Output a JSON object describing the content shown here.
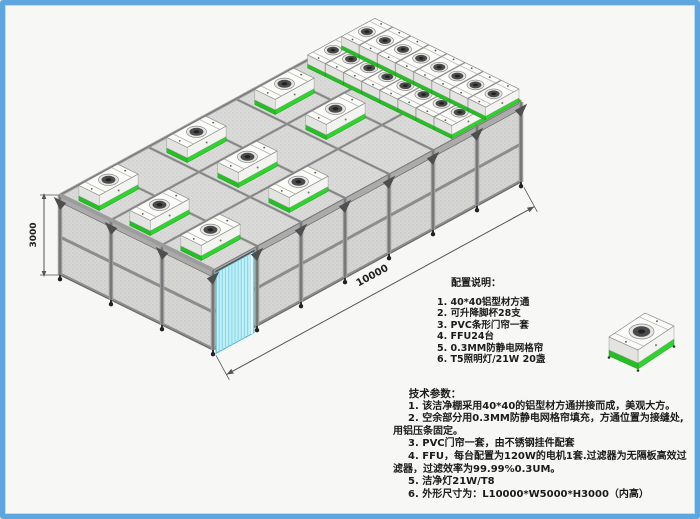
{
  "dimensions": {
    "height_mm": "3000",
    "length_mm": "10000"
  },
  "config_notes": {
    "heading": "配置说明：",
    "items": [
      "1. 40*40铝型材方通",
      "2. 可升降脚杯28支",
      "3. PVC条形门帘一套",
      "4. FFU24台",
      "5. 0.3MM防静电网格帘",
      "6. T5照明灯/21W 20盏"
    ]
  },
  "tech_params": {
    "heading": "技术参数：",
    "items": [
      "1. 该洁净棚采用40*40的铝型材方通拼接而成，美观大方。",
      "2. 空余部分用0.3MM防静电网格帘填充，方通位置为接缝处,用铝压条固定。",
      "3. PVC门帘一套，由不锈钢挂件配套",
      "4. FFU，每台配置为120W的电机1套.过滤器为无隔板高效过滤器，过滤效率为99.99%0.3UM。",
      "5. 洁净灯21W/T8",
      "6. 外形尺寸为：L10000*W5000*H3000（内高）"
    ]
  },
  "colors": {
    "border_blue": "#5ea6dd",
    "ffu_green": "#2ed32e",
    "door_cyan": "#c3eff6",
    "frame_gray": "#9a9a9a",
    "mesh_gray": "#d6d6d6",
    "dim_line": "#555555",
    "text_dark": "#1b1b1b"
  }
}
